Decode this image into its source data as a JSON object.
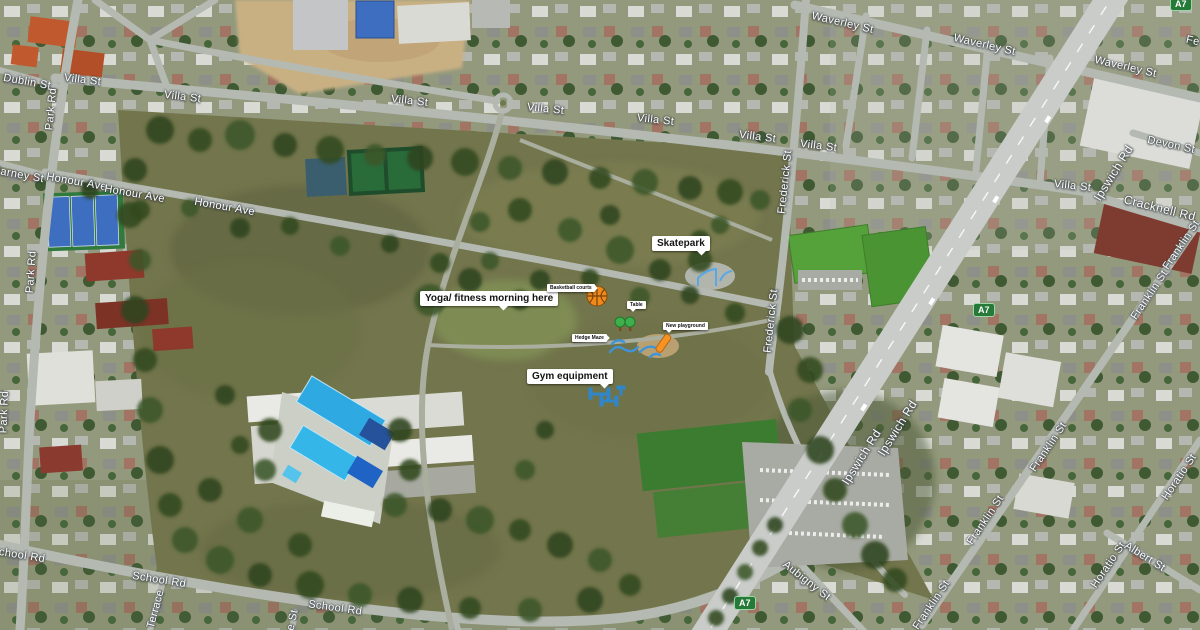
{
  "map": {
    "view": "satellite-aerial",
    "colors": {
      "park_grass": "#73754c",
      "tree_green": "#2d4420",
      "road_gray": "#b4b9b2",
      "highway_gray": "#c9ccc9",
      "pool_blue": "#35b6e8",
      "court_blue": "#3e6ec0",
      "field_green": "#55a23a",
      "route_shield_green": "#267a38",
      "label_white": "#ffffff"
    }
  },
  "route_shields": [
    {
      "text": "A7",
      "x": 1170,
      "y": -3
    },
    {
      "text": "A7",
      "x": 973,
      "y": 303
    },
    {
      "text": "A7",
      "x": 734,
      "y": 596
    }
  ],
  "street_labels": [
    {
      "text": "Dublin St",
      "x": 3,
      "y": 76,
      "rot": 10
    },
    {
      "text": "Killarney St",
      "x": -16,
      "y": 168,
      "rot": 10
    },
    {
      "text": "Park Rd",
      "x": 30,
      "y": 103,
      "rot": -85
    },
    {
      "text": "Park Rd",
      "x": 10,
      "y": 266,
      "rot": -86
    },
    {
      "text": "Park Rd",
      "x": -17,
      "y": 406,
      "rot": -88
    },
    {
      "text": "Villa St",
      "x": 64,
      "y": 74,
      "rot": 7
    },
    {
      "text": "Villa St",
      "x": 164,
      "y": 91,
      "rot": 7
    },
    {
      "text": "Villa St",
      "x": 391,
      "y": 95,
      "rot": 6
    },
    {
      "text": "Villa St",
      "x": 527,
      "y": 103,
      "rot": 6
    },
    {
      "text": "Villa St",
      "x": 637,
      "y": 114,
      "rot": 6
    },
    {
      "text": "Villa St",
      "x": 739,
      "y": 131,
      "rot": 7
    },
    {
      "text": "Villa St",
      "x": 800,
      "y": 140,
      "rot": 7
    },
    {
      "text": "Villa St",
      "x": 1054,
      "y": 180,
      "rot": 6
    },
    {
      "text": "Honour Ave",
      "x": 46,
      "y": 176,
      "rot": 10
    },
    {
      "text": "Honour Ave",
      "x": 104,
      "y": 188,
      "rot": 10
    },
    {
      "text": "Honour Ave",
      "x": 194,
      "y": 201,
      "rot": 10
    },
    {
      "text": "Waverley St",
      "x": 811,
      "y": 17,
      "rot": 13
    },
    {
      "text": "Waverley St",
      "x": 953,
      "y": 39,
      "rot": 13
    },
    {
      "text": "Waverley St",
      "x": 1094,
      "y": 61,
      "rot": 13
    },
    {
      "text": "Frederick St",
      "x": 753,
      "y": 176,
      "rot": -84
    },
    {
      "text": "Frederick St",
      "x": 739,
      "y": 315,
      "rot": -84
    },
    {
      "text": "Devon St",
      "x": 1147,
      "y": 139,
      "rot": 12
    },
    {
      "text": "Cracknell Rd",
      "x": 1123,
      "y": 201,
      "rot": 14,
      "fs": 12
    },
    {
      "text": "Ipswich Rd",
      "x": 1082,
      "y": 166,
      "rot": -58,
      "fs": 12
    },
    {
      "text": "Ipswich Rd",
      "x": 866,
      "y": 421,
      "rot": -58,
      "fs": 12
    },
    {
      "text": "Ipswich Rd",
      "x": 830,
      "y": 450,
      "rot": -58,
      "fs": 12
    },
    {
      "text": "Franklin St",
      "x": 1153,
      "y": 239,
      "rot": -56
    },
    {
      "text": "Franklin St",
      "x": 1121,
      "y": 289,
      "rot": -56
    },
    {
      "text": "Franklin St",
      "x": 1020,
      "y": 441,
      "rot": -56
    },
    {
      "text": "Franklin St",
      "x": 957,
      "y": 514,
      "rot": -56
    },
    {
      "text": "Franklin St",
      "x": 903,
      "y": 599,
      "rot": -56
    },
    {
      "text": "Horatio St",
      "x": 1153,
      "y": 471,
      "rot": -56
    },
    {
      "text": "Horatio St",
      "x": 1082,
      "y": 559,
      "rot": -56
    },
    {
      "text": "Albert St",
      "x": 1122,
      "y": 551,
      "rot": 32
    },
    {
      "text": "Aubigny St",
      "x": 778,
      "y": 575,
      "rot": 38
    },
    {
      "text": "School Rd",
      "x": -9,
      "y": 549,
      "rot": 9
    },
    {
      "text": "School Rd",
      "x": 132,
      "y": 574,
      "rot": 9
    },
    {
      "text": "School Rd",
      "x": 308,
      "y": 602,
      "rot": 8
    },
    {
      "text": "Terrace",
      "x": 136,
      "y": 603,
      "rot": -75
    },
    {
      "text": "e St",
      "x": 282,
      "y": 614,
      "rot": -78
    },
    {
      "text": "Fe",
      "x": 1186,
      "y": 35,
      "rot": 12
    }
  ],
  "callouts_large": [
    {
      "text": "Skatepark",
      "x": 652,
      "y": 236,
      "tail": "br"
    },
    {
      "text": "Yoga/ fitness morning here",
      "x": 420,
      "y": 291,
      "tail": "b"
    },
    {
      "text": "Gym equipment",
      "x": 527,
      "y": 369,
      "tail": "br"
    }
  ],
  "callouts_small": [
    {
      "text": "Basketball courts",
      "x": 547,
      "y": 284,
      "tail": "r"
    },
    {
      "text": "Table",
      "x": 627,
      "y": 301,
      "tail": "bl"
    },
    {
      "text": "New playground",
      "x": 663,
      "y": 322,
      "tail": "bl"
    },
    {
      "text": "Hedge Maze",
      "x": 572,
      "y": 334,
      "tail": "r"
    }
  ],
  "map_icons": [
    {
      "name": "basketball-icon",
      "meaning": "basketball court marker",
      "color": "#ef8b1d"
    },
    {
      "name": "trees-icon",
      "meaning": "two green trees marker",
      "color": "#3fae4c"
    },
    {
      "name": "skate-ramp-icon",
      "meaning": "blue skate ramp sketches",
      "color": "#57a8e8"
    },
    {
      "name": "water-squiggle-icon",
      "meaning": "blue squiggle sketches",
      "color": "#3f93d8"
    },
    {
      "name": "slide-icon",
      "meaning": "orange playground slide",
      "color": "#f59222"
    },
    {
      "name": "gym-equipment-icon",
      "meaning": "blue outdoor gym equipment",
      "color": "#2f86c8"
    }
  ]
}
